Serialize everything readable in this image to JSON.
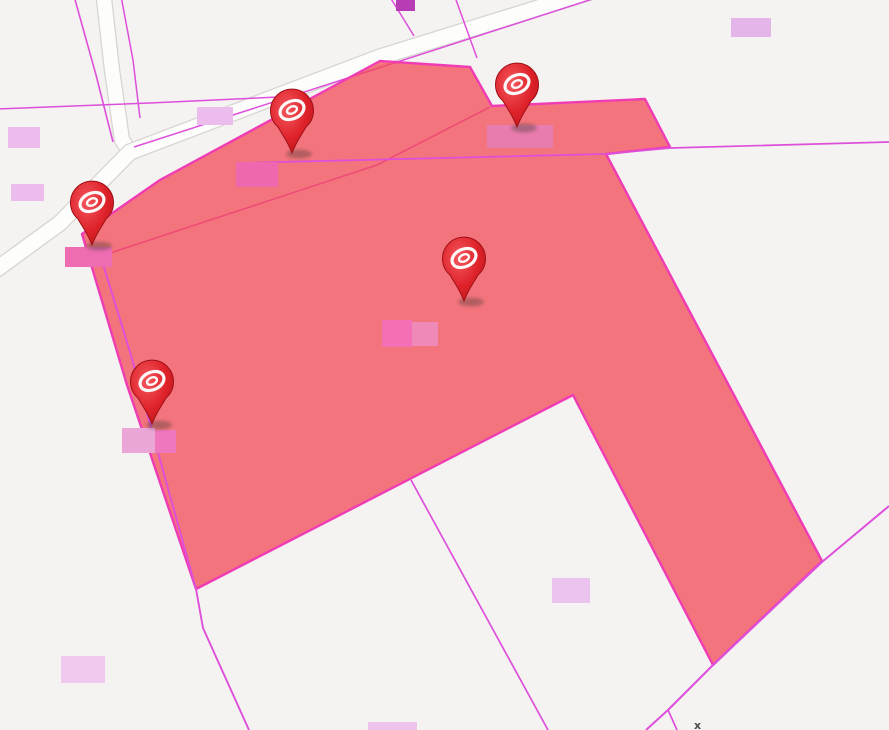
{
  "app": {
    "type": "map-viewer",
    "description": "Cadastral map with highlighted selected parcels and red location markers"
  },
  "map": {
    "width": 889,
    "height": 730,
    "background_color": "#f4f3f1",
    "road_fill_color": "#fdfdfc",
    "road_casing_color": "#d8d5d1",
    "parcel_line_color": "#dd4fdb",
    "selection": {
      "fill_color": "rgba(244,74,86,0.75)",
      "stroke_color": "#f03cb4",
      "stroke_width": 2.4,
      "points": [
        [
          82,
          234
        ],
        [
          160,
          180
        ],
        [
          380,
          61
        ],
        [
          470,
          67
        ],
        [
          492,
          106
        ],
        [
          645,
          99
        ],
        [
          670,
          147
        ],
        [
          606,
          154
        ],
        [
          822,
          561
        ],
        [
          713,
          665
        ],
        [
          573,
          395
        ],
        [
          196,
          589
        ],
        [
          127,
          385
        ]
      ]
    },
    "roads": [
      {
        "name": "road-north-south",
        "width": 14,
        "points": [
          [
            103,
            -10
          ],
          [
            112,
            70
          ],
          [
            122,
            140
          ],
          [
            130,
            152
          ]
        ]
      },
      {
        "name": "road-diagonal",
        "width": 15,
        "points": [
          [
            -10,
            274
          ],
          [
            60,
            223
          ],
          [
            130,
            152
          ],
          [
            380,
            57
          ],
          [
            596,
            -10
          ]
        ]
      }
    ],
    "parcel_lines": [
      {
        "name": "parcel-line-road-west-edge",
        "layer": "under",
        "width": 1.6,
        "points": [
          [
            74,
            -4
          ],
          [
            96,
            75
          ],
          [
            113,
            142
          ]
        ]
      },
      {
        "name": "parcel-line-road-east-edge",
        "layer": "under",
        "width": 1.5,
        "points": [
          [
            121,
            -4
          ],
          [
            133,
            60
          ],
          [
            140,
            118
          ]
        ]
      },
      {
        "name": "parcel-line-left-horizontal",
        "layer": "under",
        "width": 1.5,
        "points": [
          [
            -4,
            109
          ],
          [
            150,
            103
          ],
          [
            300,
            96
          ]
        ]
      },
      {
        "name": "parcel-line-road-north-edge",
        "layer": "under",
        "width": 1.5,
        "points": [
          [
            134,
            147
          ],
          [
            608,
            -6
          ]
        ]
      },
      {
        "name": "parcel-line-under-fill-diagonal",
        "layer": "under",
        "width": 1.6,
        "points": [
          [
            95,
            258
          ],
          [
            377,
            165
          ],
          [
            490,
            107
          ]
        ]
      },
      {
        "name": "parcel-line-top-stub-1",
        "layer": "under",
        "width": 1.5,
        "points": [
          [
            390,
            -3
          ],
          [
            414,
            36
          ]
        ]
      },
      {
        "name": "parcel-line-top-stub-2",
        "layer": "under",
        "width": 1.5,
        "points": [
          [
            455,
            -3
          ],
          [
            477,
            58
          ]
        ]
      },
      {
        "name": "parcel-line-long-horizontal",
        "layer": "over",
        "width": 1.7,
        "points": [
          [
            238,
            163
          ],
          [
            606,
            154
          ],
          [
            670,
            148
          ],
          [
            889,
            142
          ]
        ]
      },
      {
        "name": "parcel-line-left-doubled",
        "layer": "over",
        "width": 1.9,
        "points": [
          [
            99,
            251
          ],
          [
            130,
            352
          ],
          [
            196,
            589
          ],
          [
            203,
            628
          ],
          [
            249,
            730
          ]
        ]
      },
      {
        "name": "parcel-line-notch",
        "layer": "over",
        "width": 1.7,
        "points": [
          [
            411,
            480
          ],
          [
            548,
            730
          ]
        ]
      },
      {
        "name": "parcel-line-bottom-right-diagonal",
        "layer": "over",
        "width": 2.0,
        "points": [
          [
            889,
            506
          ],
          [
            822,
            562
          ],
          [
            713,
            665
          ],
          [
            668,
            710
          ],
          [
            646,
            730
          ]
        ]
      },
      {
        "name": "parcel-line-bottom-right-branch",
        "layer": "over",
        "width": 1.7,
        "points": [
          [
            668,
            710
          ],
          [
            677,
            730
          ]
        ]
      }
    ],
    "labels": [
      {
        "x": 8,
        "y": 127,
        "w": 32,
        "h": 21,
        "color": "#ecbdec"
      },
      {
        "x": 11,
        "y": 184,
        "w": 33,
        "h": 17,
        "color": "#ecbdec"
      },
      {
        "x": 197,
        "y": 107,
        "w": 36,
        "h": 18,
        "color": "#ecbdec"
      },
      {
        "x": 236,
        "y": 162,
        "w": 42,
        "h": 25,
        "color": "#ee68b0"
      },
      {
        "x": 487,
        "y": 125,
        "w": 66,
        "h": 23,
        "color": "#e87cae"
      },
      {
        "x": 382,
        "y": 320,
        "w": 30,
        "h": 27,
        "color": "#f470b6"
      },
      {
        "x": 412,
        "y": 322,
        "w": 26,
        "h": 24,
        "color": "#ef8ab8"
      },
      {
        "x": 122,
        "y": 428,
        "w": 33,
        "h": 25,
        "color": "#eba6d8"
      },
      {
        "x": 155,
        "y": 430,
        "w": 21,
        "h": 23,
        "color": "#ee77bd"
      },
      {
        "x": 65,
        "y": 247,
        "w": 47,
        "h": 20,
        "color": "#ee6cb2"
      },
      {
        "x": 552,
        "y": 578,
        "w": 38,
        "h": 25,
        "color": "#ecc3ee"
      },
      {
        "x": 61,
        "y": 656,
        "w": 44,
        "h": 27,
        "color": "#f0c9ef"
      },
      {
        "x": 368,
        "y": 722,
        "w": 49,
        "h": 8,
        "color": "#eec4ec"
      },
      {
        "x": 731,
        "y": 18,
        "w": 40,
        "h": 19,
        "color": "#e3b5e9"
      },
      {
        "x": 396,
        "y": 0,
        "w": 19,
        "h": 11,
        "color": "#b83cb4"
      }
    ],
    "markers": [
      {
        "name": "map-pin-marker-1",
        "x": 92,
        "y": 245
      },
      {
        "name": "map-pin-marker-2",
        "x": 292,
        "y": 153
      },
      {
        "name": "map-pin-marker-3",
        "x": 517,
        "y": 127
      },
      {
        "name": "map-pin-marker-4",
        "x": 464,
        "y": 301
      },
      {
        "name": "map-pin-marker-5",
        "x": 152,
        "y": 424
      }
    ],
    "marker_colors": {
      "body": "#dd2029",
      "border": "#9e1016",
      "glyph": "#ffffff"
    },
    "artifact": {
      "text": "x",
      "x": 694,
      "y": 729
    }
  }
}
